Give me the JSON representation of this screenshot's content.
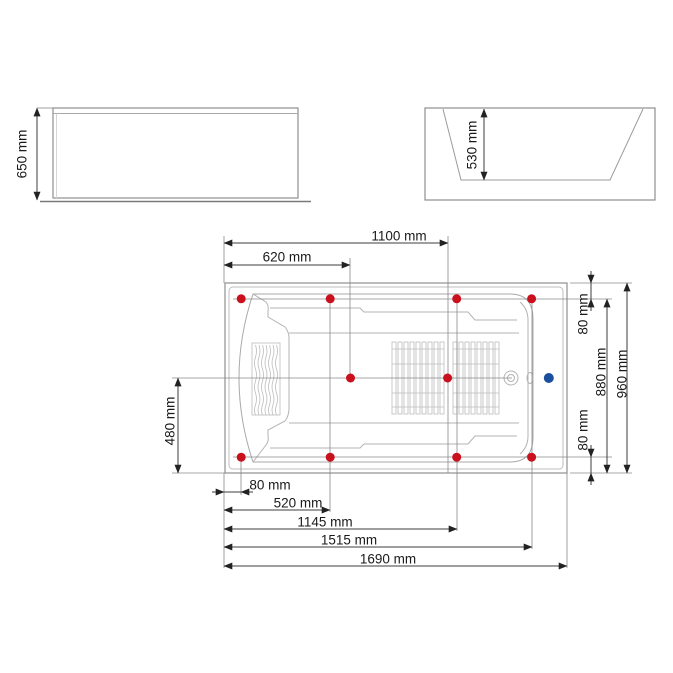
{
  "drawing": {
    "type": "bathtub-technical-drawing",
    "views": {
      "side": {
        "height_label": "650 mm"
      },
      "end": {
        "depth_label": "530 mm"
      },
      "plan": {
        "top_dims": {
          "d1100": "1100 mm",
          "d620": "620 mm"
        },
        "bottom_dims": {
          "d80": "80 mm",
          "d520": "520 mm",
          "d1145": "1145 mm",
          "d1515": "1515 mm",
          "d1690": "1690 mm"
        },
        "right_dims": {
          "d80_top": "80 mm",
          "d880": "880 mm",
          "d960": "960 mm",
          "d80_bottom": "80 mm"
        },
        "left_dims": {
          "d480": "480 mm"
        }
      }
    },
    "jets_mm": [
      {
        "x": 80,
        "y": 80
      },
      {
        "x": 520,
        "y": 80
      },
      {
        "x": 1145,
        "y": 80
      },
      {
        "x": 1515,
        "y": 80
      },
      {
        "x": 620,
        "y": 480
      },
      {
        "x": 1100,
        "y": 480
      },
      {
        "x": 80,
        "y": 880
      },
      {
        "x": 520,
        "y": 880
      },
      {
        "x": 1145,
        "y": 880
      },
      {
        "x": 1515,
        "y": 880
      }
    ],
    "inlet_mm": {
      "x": 1600,
      "y": 480
    },
    "colors": {
      "jet": "#c9101c",
      "inlet": "#1a4f9e",
      "outline": "#8f8f8f",
      "tub_line": "#b3b3b3",
      "dim_line": "#3c3c3c",
      "text": "#1a1a1a"
    }
  }
}
